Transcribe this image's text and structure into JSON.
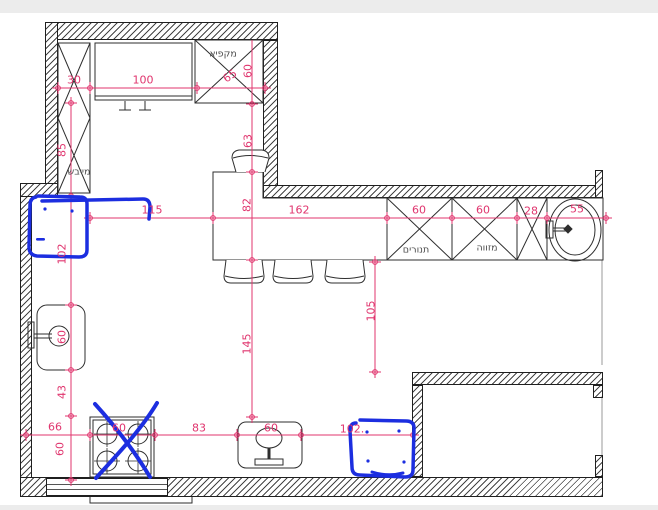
{
  "drawing_title": "kitchen-floor-plan",
  "colors": {
    "dimension": "#e0356e",
    "annotation": "#1c2ee0",
    "wall_line": "#1f1f1f",
    "fixture_line": "#2e2e2e"
  },
  "labels": {
    "appliances": [
      {
        "id": "label-freezer",
        "text": "מקפיא",
        "x": 223,
        "y": 54,
        "rot": 0
      },
      {
        "id": "label-dryer",
        "text": "מייבש",
        "x": 79,
        "y": 172,
        "rot": 0
      },
      {
        "id": "label-ovens",
        "text": "תנורים",
        "x": 416,
        "y": 250,
        "rot": 0
      },
      {
        "id": "label-pantry",
        "text": "מזווה",
        "x": 487,
        "y": 248,
        "rot": 0
      }
    ],
    "dimensions": [
      {
        "id": "dim-30",
        "text": "30",
        "x": 74,
        "y": 80,
        "rot": 0
      },
      {
        "id": "dim-100",
        "text": "100",
        "x": 143,
        "y": 80,
        "rot": 0
      },
      {
        "id": "dim-65",
        "text": "65",
        "x": 230,
        "y": 76,
        "rot": -35
      },
      {
        "id": "dim-60-freezer",
        "text": "60",
        "x": 248,
        "y": 71,
        "rot": -90
      },
      {
        "id": "dim-63",
        "text": "63",
        "x": 248,
        "y": 141,
        "rot": -90
      },
      {
        "id": "dim-85",
        "text": "85",
        "x": 62,
        "y": 150,
        "rot": -90
      },
      {
        "id": "dim-115",
        "text": "115",
        "x": 152,
        "y": 210,
        "rot": 0
      },
      {
        "id": "dim-82",
        "text": "82",
        "x": 247,
        "y": 205,
        "rot": -90
      },
      {
        "id": "dim-162",
        "text": "162",
        "x": 299,
        "y": 210,
        "rot": 0
      },
      {
        "id": "dim-60-ovens",
        "text": "60",
        "x": 419,
        "y": 210,
        "rot": 0
      },
      {
        "id": "dim-60-pantry",
        "text": "60",
        "x": 483,
        "y": 210,
        "rot": 0
      },
      {
        "id": "dim-28",
        "text": "28",
        "x": 531,
        "y": 211,
        "rot": 0
      },
      {
        "id": "dim-55",
        "text": "55",
        "x": 577,
        "y": 209,
        "rot": 0
      },
      {
        "id": "dim-102-left",
        "text": "102",
        "x": 62,
        "y": 254,
        "rot": -90
      },
      {
        "id": "dim-60-sink-l",
        "text": "60",
        "x": 62,
        "y": 337,
        "rot": -90
      },
      {
        "id": "dim-43",
        "text": "43",
        "x": 62,
        "y": 392,
        "rot": -90
      },
      {
        "id": "dim-145",
        "text": "145",
        "x": 247,
        "y": 344,
        "rot": -90
      },
      {
        "id": "dim-105",
        "text": "105",
        "x": 371,
        "y": 311,
        "rot": -90
      },
      {
        "id": "dim-66",
        "text": "66",
        "x": 55,
        "y": 427,
        "rot": 0
      },
      {
        "id": "dim-60-depth",
        "text": "60",
        "x": 60,
        "y": 449,
        "rot": -90
      },
      {
        "id": "dim-60-stove",
        "text": "60",
        "x": 119,
        "y": 428,
        "rot": 0
      },
      {
        "id": "dim-83",
        "text": "83",
        "x": 199,
        "y": 428,
        "rot": 0
      },
      {
        "id": "dim-60-sink-b",
        "text": "60",
        "x": 271,
        "y": 428,
        "rot": 0
      },
      {
        "id": "dim-102-bottom",
        "text": "102.",
        "x": 352,
        "y": 429,
        "rot": 0
      }
    ]
  }
}
